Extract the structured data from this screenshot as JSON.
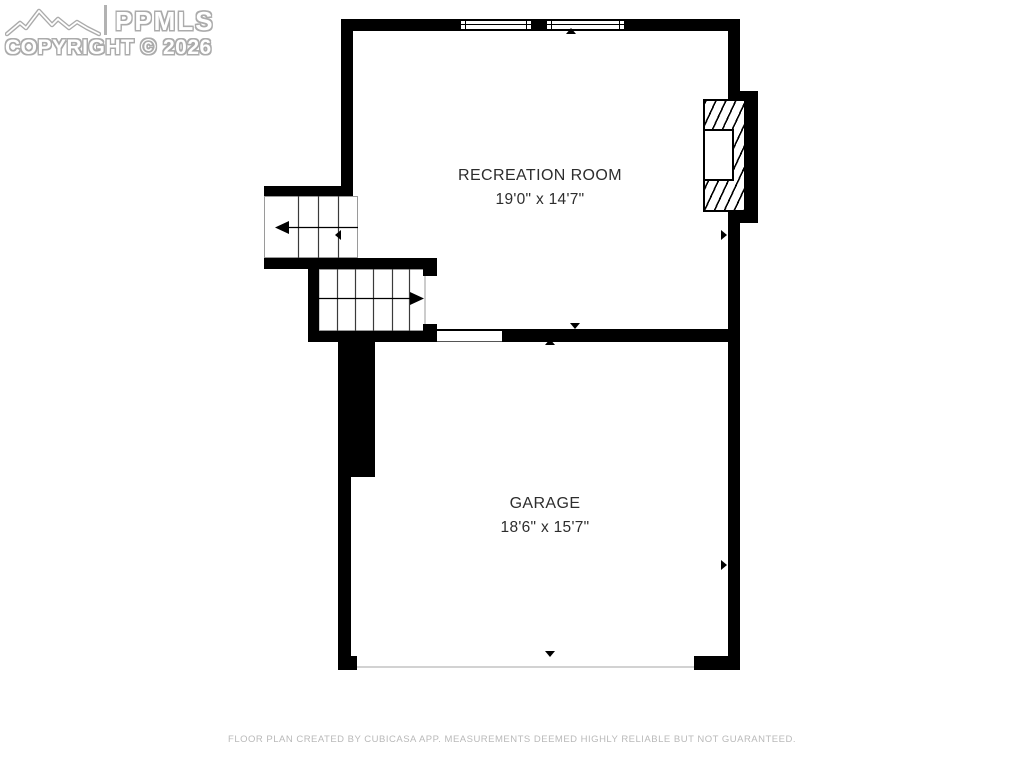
{
  "watermark": {
    "brand": "PPMLS",
    "copyright_line": "COPYRIGHT © 2026"
  },
  "rooms": [
    {
      "name": "RECREATION ROOM",
      "dimensions": "19'0\" x 14'7\""
    },
    {
      "name": "GARAGE",
      "dimensions": "18'6\" x 15'7\""
    }
  ],
  "footer": {
    "text": "FLOOR PLAN CREATED BY CUBICASA APP. MEASUREMENTS DEEMED HIGHLY RELIABLE BUT NOT GUARANTEED."
  },
  "colors": {
    "wall": "#000000",
    "background": "#ffffff",
    "label_text": "#2d2d2d",
    "footer_text": "#b9b9b9",
    "watermark_outline": "#ababab",
    "threshold_line": "#d2d2d2"
  },
  "icons": {
    "mountain-logo-icon": "mountain range outline",
    "stair-up-arrow-icon": "◀",
    "stair-down-arrow-icon": "▶",
    "marker-up-icon": "▲",
    "marker-down-icon": "▼",
    "marker-left-icon": "◀",
    "marker-right-icon": "▶"
  }
}
